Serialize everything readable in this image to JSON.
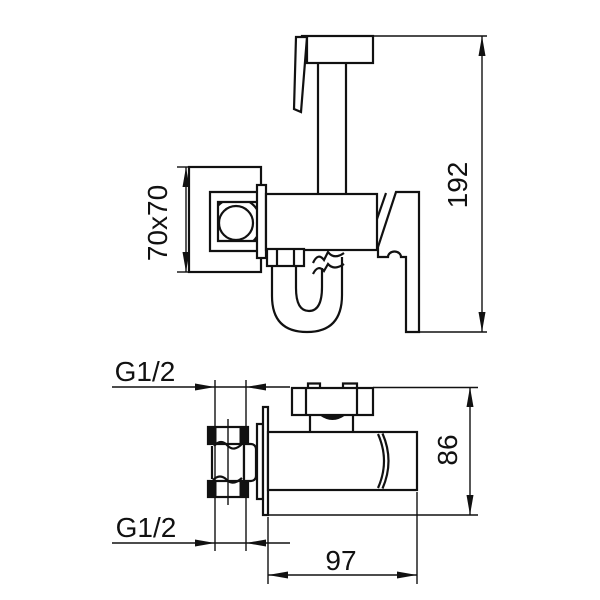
{
  "canvas": {
    "background": "#ffffff",
    "line_color": "#111111"
  },
  "side_view": {
    "dim_total_height": "192",
    "dim_plate_size": "70x70"
  },
  "plan_view": {
    "dim_thread_top": "G1/2",
    "dim_thread_bottom": "G1/2",
    "dim_depth": "86",
    "dim_width": "97"
  }
}
